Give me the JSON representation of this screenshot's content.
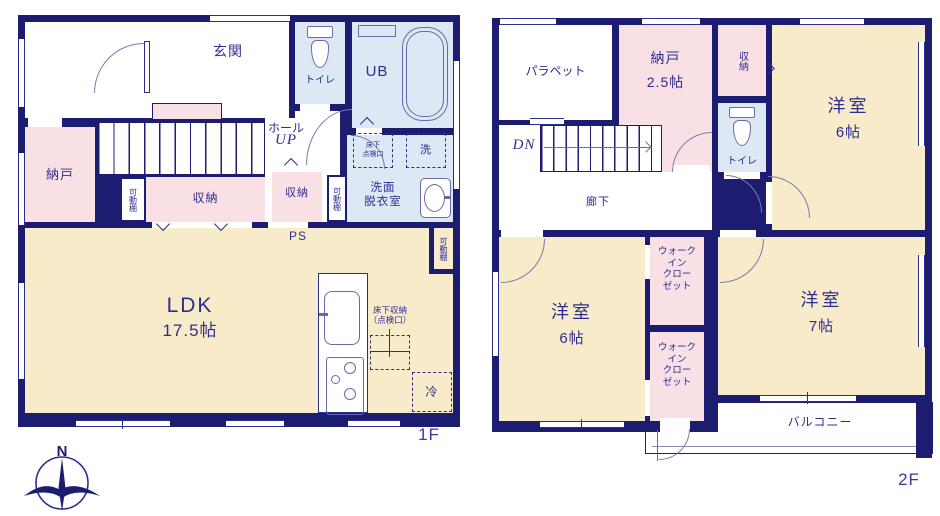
{
  "title": "間取り図",
  "colors": {
    "wall": "#1c1c70",
    "room_cream": "#f8ebc9",
    "room_pink": "#f9e0e5",
    "room_blue": "#dce8f3",
    "text": "#2d2d8f",
    "fixture_line": "#6a6aa8"
  },
  "f1": {
    "label": "1F",
    "genkan": "玄関",
    "toilet": "トイレ",
    "ub": "UB",
    "hall": "ホール",
    "up": "UP",
    "nando": "納戸",
    "kadodana": "可動棚",
    "shuno": "収納",
    "shuno2": "収納",
    "kadodana2": "可動棚",
    "kadodana3": "可動棚",
    "yukashita_tenken": "床下\n点検口",
    "laundry": "洗",
    "senmen": "洗面\n脱衣室",
    "ps": "PS",
    "ldk": "LDK",
    "ldk_size": "17.5帖",
    "yukashita_shuno": "床下収納\n（点検口）",
    "fridge": "冷"
  },
  "f2": {
    "label": "2F",
    "parapet": "パラペット",
    "nando": "納戸",
    "nando_size": "2.5帖",
    "shuno": "収納",
    "toilet": "トイレ",
    "dn": "DN",
    "rouka": "廊下",
    "room_ne": "洋室",
    "room_ne_size": "6帖",
    "room_sw": "洋室",
    "room_sw_size": "6帖",
    "room_e": "洋室",
    "room_e_size": "7帖",
    "wic": "ウォーク\nイン\nクロー\nゼット",
    "wic2": "ウォーク\nイン\nクロー\nゼット",
    "balcony": "バルコニー"
  },
  "compass": {
    "n": "N"
  }
}
